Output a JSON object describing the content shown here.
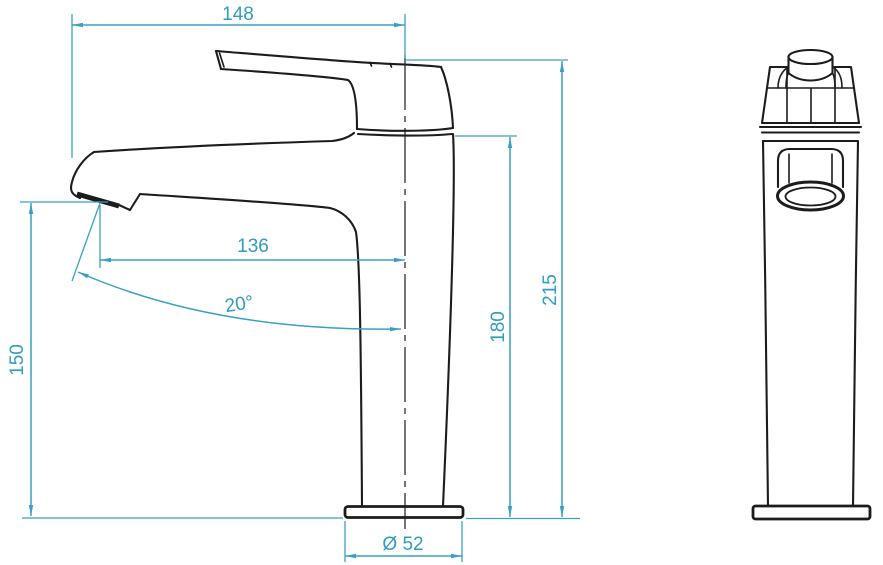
{
  "drawing": {
    "colors": {
      "dimension_accent": "#3AA1C2",
      "dimension_text": "#2F9DBD",
      "outline": "#1C1C1C",
      "background": "#FFFFFF"
    },
    "dimensions": {
      "top_width": {
        "label": "148"
      },
      "spout_reach": {
        "label": "136"
      },
      "spout_angle": {
        "label": "20°"
      },
      "spout_height": {
        "label": "150"
      },
      "body_height": {
        "label": "180"
      },
      "total_height": {
        "label": "215"
      },
      "base_diameter": {
        "label": "Ø 52"
      }
    }
  }
}
